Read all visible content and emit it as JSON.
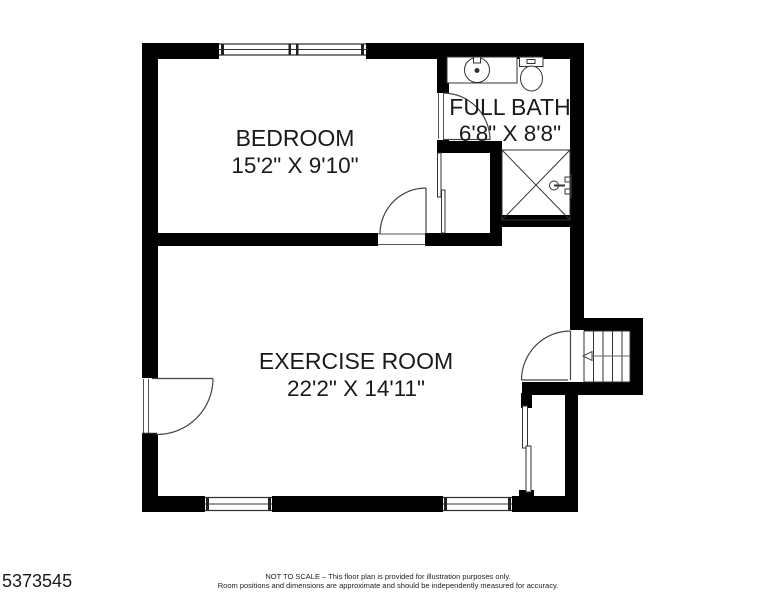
{
  "colors": {
    "wall": "#000000",
    "thin_line": "#333333",
    "door_arc": "#555555",
    "background": "#ffffff",
    "text": "#1a1a1a"
  },
  "rooms": {
    "bedroom": {
      "name": "BEDROOM",
      "dims": "15'2\" X 9'10\""
    },
    "bath": {
      "name": "FULL BATH",
      "dims": "6'8\" X 8'8\""
    },
    "exercise": {
      "name": "EXERCISE ROOM",
      "dims": "22'2\" X 14'11\""
    }
  },
  "fixtures": {
    "sink": "bathroom-sink",
    "toilet": "toilet",
    "shower": "shower-stall",
    "stairs": "staircase",
    "closet_door": "sliding-closet-door",
    "windows": "window",
    "doors": "swing-door"
  },
  "footer": {
    "mls": "5373545",
    "line1": "NOT TO SCALE – This floor plan is provided for illustration purposes only.",
    "line2": "Room positions and dimensions are approximate and should be independently measured for accuracy."
  }
}
